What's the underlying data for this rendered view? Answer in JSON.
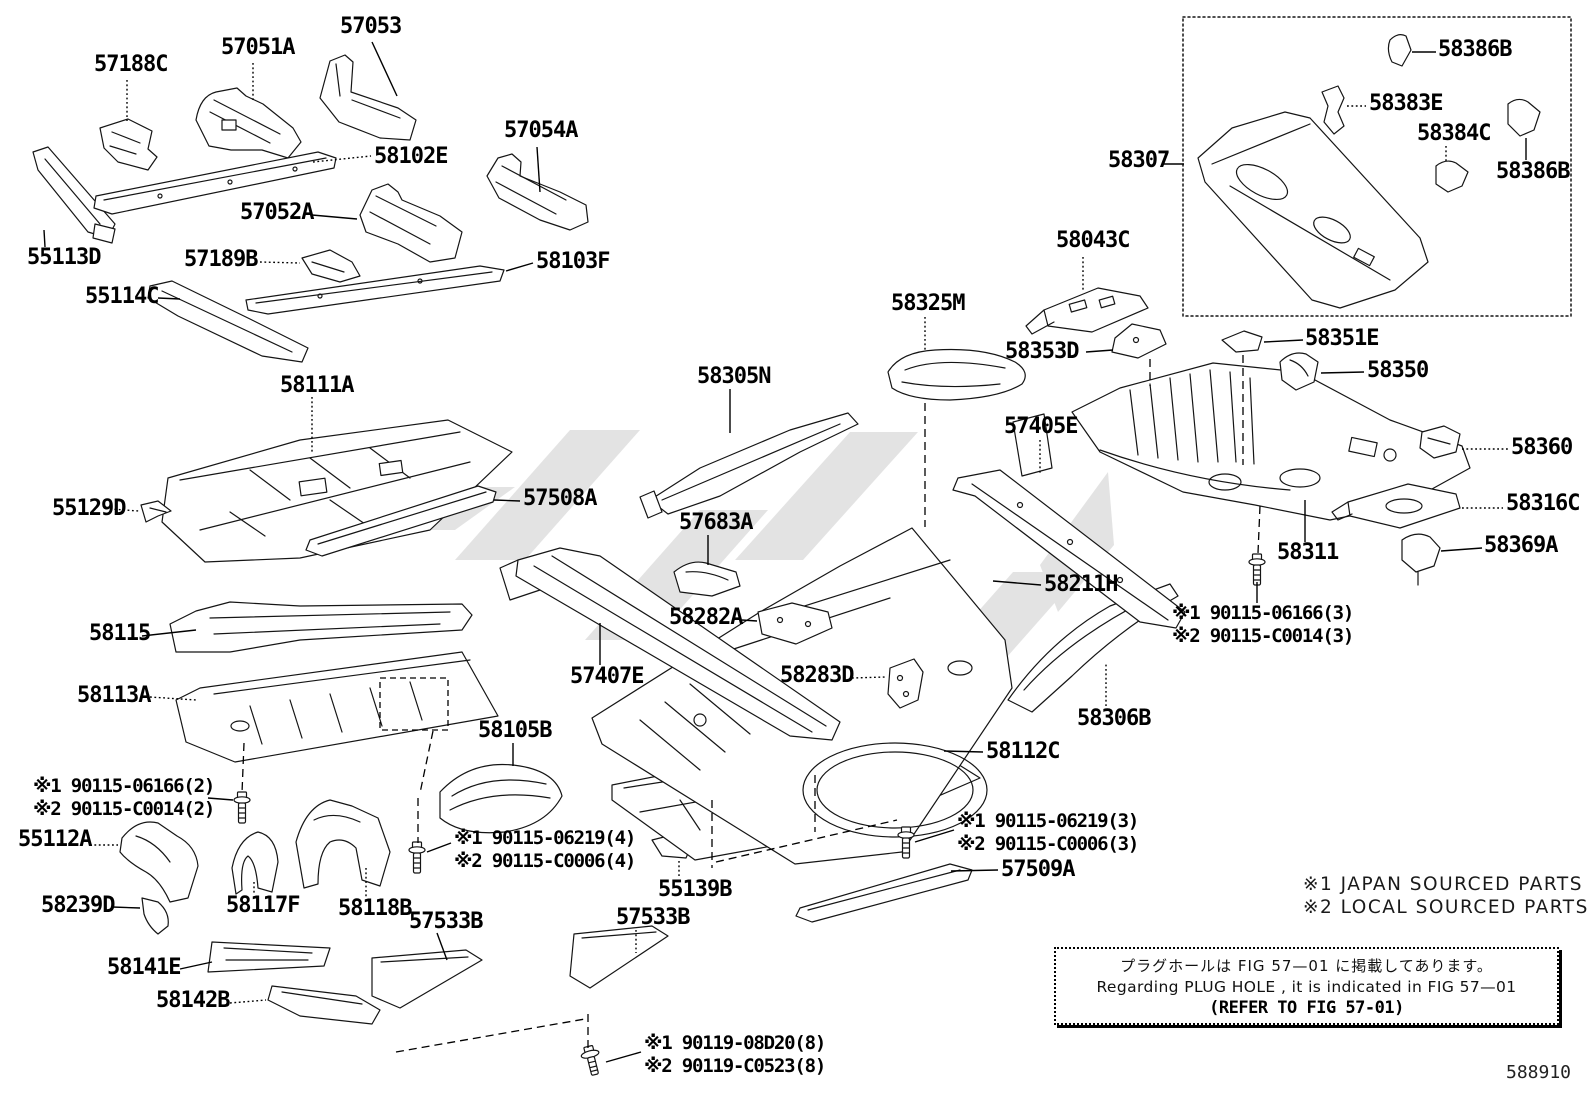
{
  "figure_code": "588910",
  "sourcing_notes": [
    "※1 JAPAN SOURCED PARTS",
    "※2 LOCAL SOURCED PARTS"
  ],
  "plug_hole_note": {
    "jp": "プラグホールは FIG  57—01 に掲載してあります。",
    "en": "Regarding  PLUG  HOLE , it is indicated in FIG  57—01",
    "ref": "(REFER  TO  FIG  57-01)"
  },
  "part_labels": [
    {
      "text": "57188C",
      "x": 94,
      "y": 55
    },
    {
      "text": "57051A",
      "x": 221,
      "y": 38
    },
    {
      "text": "57053",
      "x": 340,
      "y": 17
    },
    {
      "text": "57054A",
      "x": 504,
      "y": 121
    },
    {
      "text": "58102E",
      "x": 374,
      "y": 147
    },
    {
      "text": "57052A",
      "x": 240,
      "y": 203
    },
    {
      "text": "55113D",
      "x": 27,
      "y": 248
    },
    {
      "text": "57189B",
      "x": 184,
      "y": 250
    },
    {
      "text": "58103F",
      "x": 536,
      "y": 252
    },
    {
      "text": "55114C",
      "x": 85,
      "y": 287
    },
    {
      "text": "58111A",
      "x": 280,
      "y": 376
    },
    {
      "text": "55129D",
      "x": 52,
      "y": 499
    },
    {
      "text": "57508A",
      "x": 523,
      "y": 489
    },
    {
      "text": "58115",
      "x": 89,
      "y": 624
    },
    {
      "text": "58113A",
      "x": 77,
      "y": 686
    },
    {
      "text": "58105B",
      "x": 478,
      "y": 721
    },
    {
      "text": "55112A",
      "x": 18,
      "y": 830
    },
    {
      "text": "58239D",
      "x": 41,
      "y": 896
    },
    {
      "text": "58117F",
      "x": 226,
      "y": 896
    },
    {
      "text": "58118B",
      "x": 338,
      "y": 899
    },
    {
      "text": "57533B",
      "x": 409,
      "y": 912
    },
    {
      "text": "58141E",
      "x": 107,
      "y": 958
    },
    {
      "text": "58142B",
      "x": 156,
      "y": 991
    },
    {
      "text": "55139B",
      "x": 658,
      "y": 880
    },
    {
      "text": "57533B",
      "x": 616,
      "y": 908
    },
    {
      "text": "58305N",
      "x": 697,
      "y": 367
    },
    {
      "text": "58325M",
      "x": 891,
      "y": 294
    },
    {
      "text": "57683A",
      "x": 679,
      "y": 513
    },
    {
      "text": "58282A",
      "x": 669,
      "y": 608
    },
    {
      "text": "57407E",
      "x": 570,
      "y": 667
    },
    {
      "text": "58283D",
      "x": 780,
      "y": 666
    },
    {
      "text": "58211H",
      "x": 1044,
      "y": 575
    },
    {
      "text": "58306B",
      "x": 1077,
      "y": 709
    },
    {
      "text": "58112C",
      "x": 986,
      "y": 742
    },
    {
      "text": "57509A",
      "x": 1001,
      "y": 860
    },
    {
      "text": "57405E",
      "x": 1004,
      "y": 417
    },
    {
      "text": "58353D",
      "x": 1005,
      "y": 342
    },
    {
      "text": "58043C",
      "x": 1056,
      "y": 231
    },
    {
      "text": "58351E",
      "x": 1305,
      "y": 329
    },
    {
      "text": "58350",
      "x": 1367,
      "y": 361
    },
    {
      "text": "58360",
      "x": 1511,
      "y": 438
    },
    {
      "text": "58316C",
      "x": 1506,
      "y": 494
    },
    {
      "text": "58369A",
      "x": 1484,
      "y": 536
    },
    {
      "text": "58311",
      "x": 1277,
      "y": 543
    },
    {
      "text": "58307",
      "x": 1108,
      "y": 151
    },
    {
      "text": "58386B",
      "x": 1438,
      "y": 40
    },
    {
      "text": "58383E",
      "x": 1369,
      "y": 94
    },
    {
      "text": "58384C",
      "x": 1417,
      "y": 124
    },
    {
      "text": "58386B",
      "x": 1496,
      "y": 162
    }
  ],
  "fastener_notes": [
    {
      "lines": [
        "※1 90115-06166(2)",
        "※2 90115-C0014(2)"
      ],
      "x": 33,
      "y": 775
    },
    {
      "lines": [
        "※1 90115-06219(4)",
        "※2 90115-C0006(4)"
      ],
      "x": 454,
      "y": 827
    },
    {
      "lines": [
        "※1 90119-08D20(8)",
        "※2 90119-C0523(8)"
      ],
      "x": 644,
      "y": 1032
    },
    {
      "lines": [
        "※1 90115-06219(3)",
        "※2 90115-C0006(3)"
      ],
      "x": 957,
      "y": 810
    },
    {
      "lines": [
        "※1 90115-06166(3)",
        "※2 90115-C0014(3)"
      ],
      "x": 1172,
      "y": 602
    }
  ]
}
